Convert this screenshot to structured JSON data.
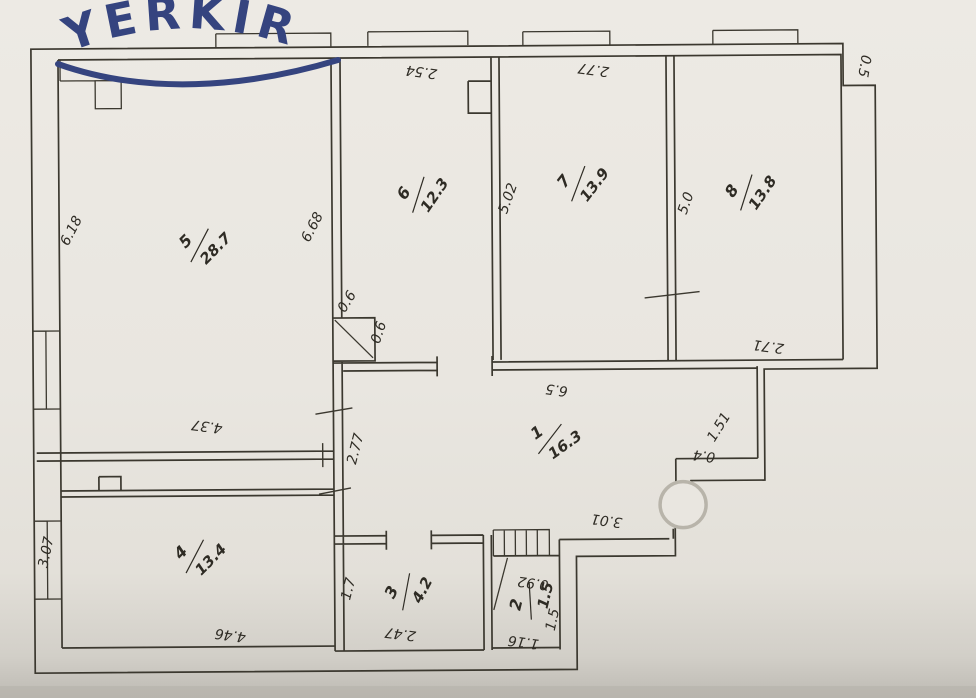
{
  "logo": {
    "text": "YERKIR"
  },
  "colors": {
    "paper": "#e9e6e0",
    "ink": "#3b382f",
    "logo": "#35447f",
    "column_circle": "#b8b4aa"
  },
  "rooms": {
    "r1": {
      "number": "1",
      "area": "16.3"
    },
    "r2": {
      "number": "2",
      "area": "1.5"
    },
    "r3": {
      "number": "3",
      "area": "4.2"
    },
    "r4": {
      "number": "4",
      "area": "13.4"
    },
    "r5": {
      "number": "5",
      "area": "28.7"
    },
    "r6": {
      "number": "6",
      "area": "12.3"
    },
    "r7": {
      "number": "7",
      "area": "13.9"
    },
    "r8": {
      "number": "8",
      "area": "13.8"
    }
  },
  "dims": {
    "room5_left": "6.18",
    "room5_right": "6.68",
    "room5_width": "4.37",
    "room6_top": "2.54",
    "room6_height": "5.02",
    "room7_top": "2.77",
    "room78_height": "5.0",
    "corner_notch": "0.5",
    "room8_bottom": "2.71",
    "hall_top": "6.5",
    "hall_west": "2.77",
    "hall_east": "1.51",
    "hall_step": "0.4",
    "hall_south": "3.01",
    "shaft_w": "0.6",
    "shaft_h": "0.6",
    "room4_left": "3.07",
    "room4_bottom": "4.46",
    "room3_left": "1.7",
    "room3_bottom": "2.47",
    "room2_top": "0.92",
    "room2_bottom": "1.16",
    "room2_height": "1.5"
  }
}
